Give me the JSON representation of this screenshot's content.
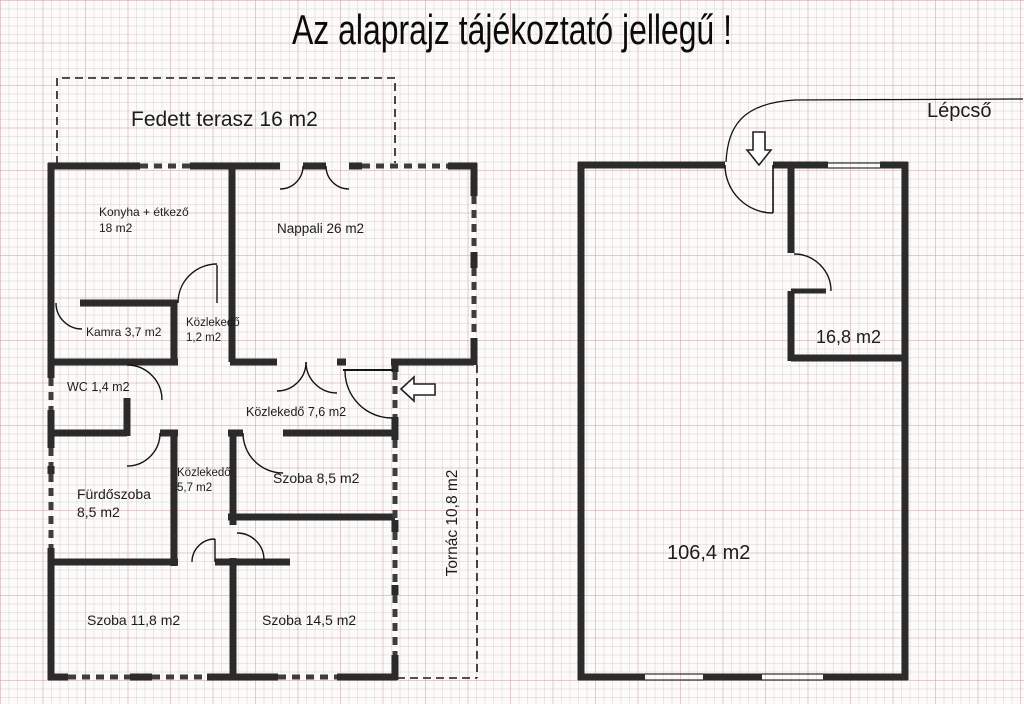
{
  "title": "Az alaprajz tájékoztató jellegű !",
  "colors": {
    "wall": "#2b2b2b",
    "window_dash": "#3d3d3d",
    "thin_line": "#111111",
    "grid_minor": "#e9e9e6",
    "grid_accent": "#f2d6d6",
    "background": "#fcfbf9"
  },
  "rooms": {
    "fedett_terasz": {
      "name": "Fedett terasz",
      "area": "16 m2"
    },
    "konyha": {
      "name": "Konyha + étkező",
      "area": "18 m2"
    },
    "nappali": {
      "name": "Nappali",
      "area": "26 m2"
    },
    "kamra": {
      "name": "Kamra",
      "area": "3,7 m2"
    },
    "kozlekedo_kis": {
      "name": "Közlekedő",
      "area": "1,2 m2"
    },
    "wc": {
      "name": "WC",
      "area": "1,4 m2"
    },
    "kozlekedo_nagy": {
      "name": "Közlekedő",
      "area": "7,6 m2"
    },
    "furdoszoba": {
      "name": "Fürdőszoba",
      "area": "8,5 m2"
    },
    "kozlekedo_kozep": {
      "name": "Közlekedő",
      "area": "5,7 m2"
    },
    "szoba_85": {
      "name": "Szoba",
      "area": "8,5 m2"
    },
    "szoba_118": {
      "name": "Szoba",
      "area": "11,8 m2"
    },
    "szoba_145": {
      "name": "Szoba",
      "area": "14,5 m2"
    },
    "tornac": {
      "name": "Tornác",
      "area": "10,8 m2"
    },
    "emeleti_szoba": {
      "name": "",
      "area": "16,8 m2"
    },
    "emeleti_ter": {
      "name": "",
      "area": "106,4 m2"
    }
  },
  "annotations": {
    "stairs": "Lépcső"
  }
}
